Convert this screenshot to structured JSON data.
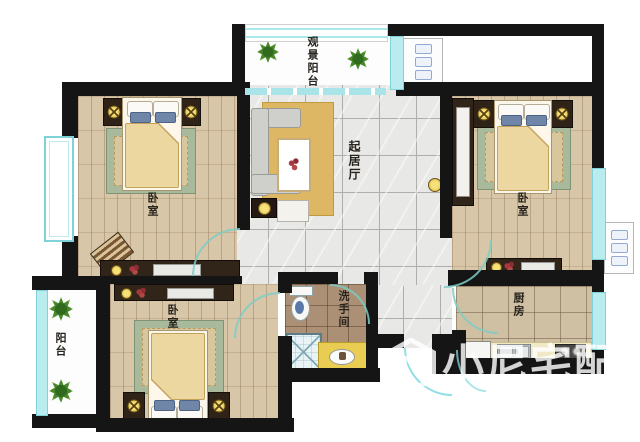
{
  "colors": {
    "wall": "#151515",
    "window": "#b9ecef",
    "windowFrame": "#7fd2d8",
    "tileFloor": "#e8e8e6",
    "tileLine": "#aeaeac",
    "woodFloor": "#d8c6a8",
    "bathFloor": "#ab9076",
    "kitchenFloor": "#d0c0a3",
    "rugGreen": "#a9b99c",
    "rugInner": "#d8c69c",
    "rugGold": "#ddb763",
    "blanket": "#ecd7a0",
    "darkWood": "#31251a",
    "sofa": "#cfcfcb",
    "gold": "#e9cc52",
    "door": "#7dcdc6",
    "watermark": "rgba(255,255,255,0.82)"
  },
  "rooms": {
    "view_balcony": {
      "label": "观景阳台"
    },
    "bedroom_top_left": {
      "label": "卧室"
    },
    "bedroom_right": {
      "label": "卧室"
    },
    "bedroom_bottom": {
      "label": "卧室"
    },
    "living_room": {
      "label": "起居厅"
    },
    "bathroom": {
      "label": "洗手间"
    },
    "kitchen": {
      "label": "厨房"
    },
    "balcony": {
      "label": "阳台"
    }
  },
  "watermark": {
    "logo_letter": "N",
    "text": "小尼宅配"
  }
}
